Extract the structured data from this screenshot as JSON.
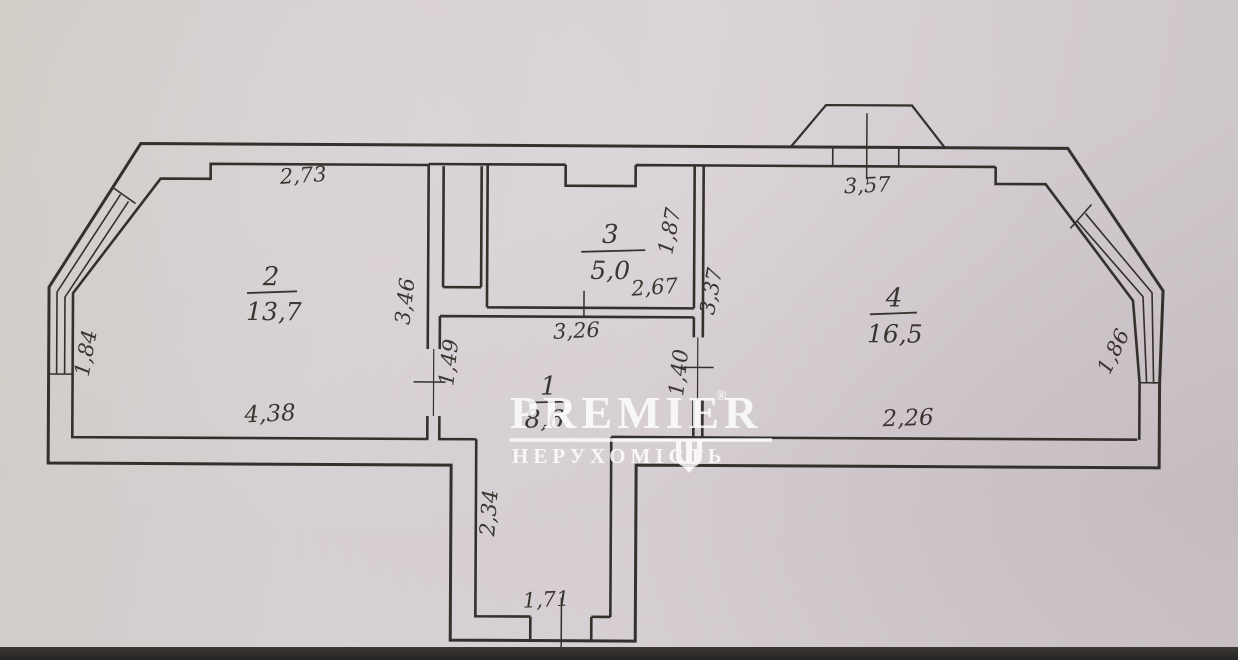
{
  "document": {
    "kind": "apartment floor plan (BTI scan photo)"
  },
  "colors": {
    "paper": "#d5ced2",
    "wall_line": "#34302b",
    "label_text": "#3a3530",
    "watermark": "#ffffff",
    "photo_edge": "#2f2d2a"
  },
  "rooms": [
    {
      "number": "2",
      "area": "13,7"
    },
    {
      "number": "3",
      "area": "5,0"
    },
    {
      "number": "4",
      "area": "16,5"
    },
    {
      "number": "1",
      "area": "8,6"
    }
  ],
  "dimensions": {
    "room2_top": "2,73",
    "room2_left_window": "1,84",
    "room2_right_wall": "3,46",
    "room2_bottom": "4,38",
    "room2_door": "1,49",
    "room3_right_wall": "1,87",
    "room3_width": "2,67",
    "hall_top": "3,26",
    "balcony_top": "3,57",
    "room4_left_wall": "3,37",
    "room4_door": "1,40",
    "room4_right_window": "1,86",
    "room4_bottom": "2,26",
    "hall_lower_height": "2,34",
    "entry_width": "1,71"
  },
  "watermark": {
    "brand": "PREMIER",
    "registered_mark": "®",
    "subtitle": "НЕРУХОМІСТЬ",
    "icon": "tryzub-trident"
  }
}
